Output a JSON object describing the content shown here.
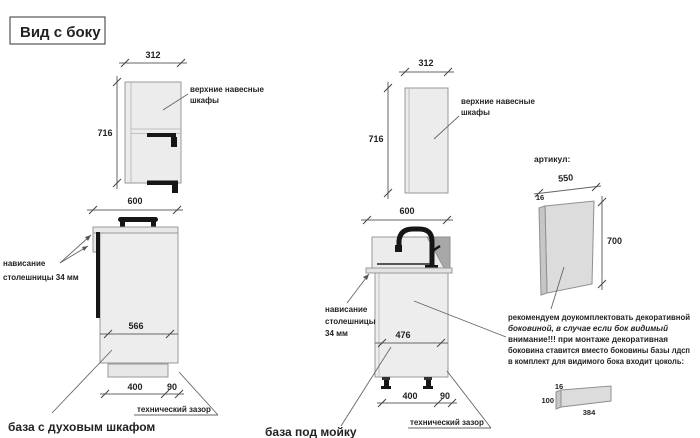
{
  "title": "Вид с боку",
  "colors": {
    "warning_red": "#bf4040"
  },
  "left_upper": {
    "width": "312",
    "height": "716",
    "label_line1": "верхние навесные",
    "label_line2": "шкафы"
  },
  "left_base": {
    "width": "600",
    "inner_width": "566",
    "plinth_width": "400",
    "gap_width": "90",
    "overhang_line1": "нависание",
    "overhang_line2": "столешницы 34 мм",
    "gap_label": "технический зазор",
    "caption": "база с духовым шкафом"
  },
  "mid_upper": {
    "width": "312",
    "height": "716",
    "label_line1": "верхние навесные",
    "label_line2": "шкафы"
  },
  "mid_base": {
    "width": "600",
    "inner_width": "476",
    "plinth_width": "400",
    "gap_width": "90",
    "overhang_line1": "нависание",
    "overhang_line2": "столешницы",
    "overhang_line3": "34 мм",
    "gap_label": "технический зазор",
    "caption": "база под мойку"
  },
  "side_panel": {
    "header": "артикул:",
    "width": "550",
    "thickness": "16",
    "height": "700"
  },
  "note": {
    "line1": "рекомендуем доукомплектовать декоративной",
    "line2": "боковиной, в случае если бок видимый",
    "line3": "внимание!!! при монтаже декоративная",
    "line4": "боковина ставится вместо боковины базы лдсп",
    "line5": "в комплект для видимого бока входит цоколь:"
  },
  "plinth": {
    "thickness": "16",
    "height": "100",
    "width": "384"
  }
}
